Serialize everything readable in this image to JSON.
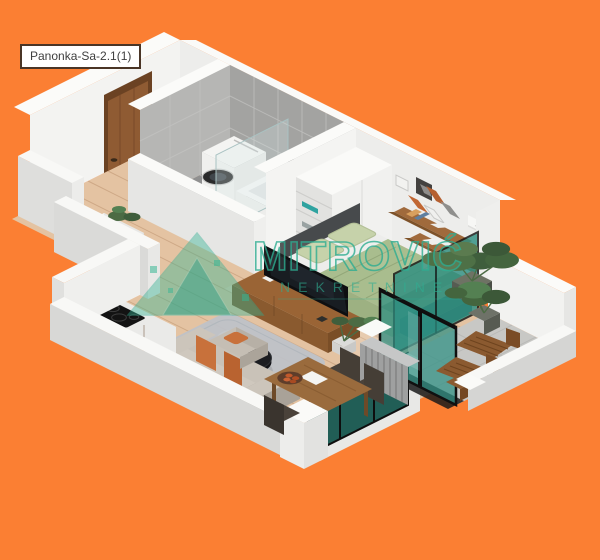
{
  "plan_label": {
    "text": "Panonka-Sa-2.1(1)"
  },
  "watermark": {
    "brand": "MITROVIĆ",
    "subtitle": "NEKRETNINE",
    "color": "#2FAE92"
  },
  "palette": {
    "orange_background": "#FB7F33",
    "wall_white": "#F4F4F2",
    "wall_shadow": "#D8D8D6",
    "tile_gray": "#A8A8A6",
    "wood_floor": "#E4C3A2",
    "furniture_wood": "#9A6435",
    "bed_green": "#A9BD8E",
    "glass_teal": "#2E8F82",
    "sofa_beige": "#C9C2B8",
    "pillow_orange": "#C8713B",
    "tv_black": "#0E0F11",
    "plant_green": "#4C6B44",
    "label_border": "#4A3526"
  }
}
